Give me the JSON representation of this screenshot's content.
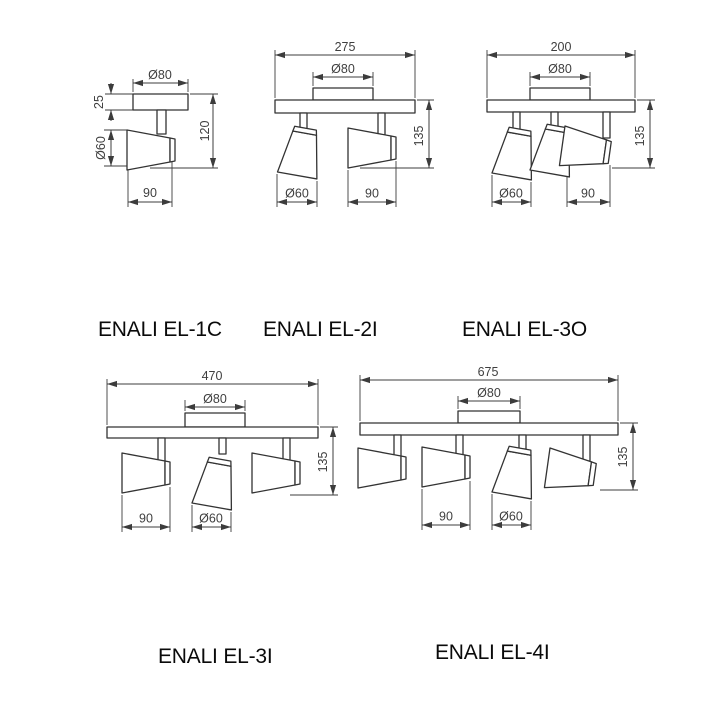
{
  "page": {
    "background": "#ffffff",
    "line_color": "#333333",
    "dimension_text_color": "#3f3f3f",
    "label_color": "#0a0a0a"
  },
  "figures": [
    {
      "name": "ENALI EL-1C",
      "type": "single ceiling spotlight drawing",
      "dims": {
        "canopy_diameter": "Ø80",
        "canopy_height": "25",
        "head_diameter": "Ø60",
        "total_height": "120",
        "head_length": "90"
      }
    },
    {
      "name": "ENALI EL-2I",
      "type": "2-head spotlight bar drawing",
      "dims": {
        "overall_length": "275",
        "canopy_diameter": "Ø80",
        "total_height": "135",
        "head_diameter": "Ø60",
        "head_length": "90"
      }
    },
    {
      "name": "ENALI EL-3O",
      "type": "3-head spotlight bar drawing",
      "dims": {
        "overall_length": "200",
        "canopy_diameter": "Ø80",
        "total_height": "135",
        "head_diameter": "Ø60",
        "head_length": "90"
      }
    },
    {
      "name": "ENALI EL-3I",
      "type": "3-head spotlight bar drawing",
      "dims": {
        "overall_length": "470",
        "canopy_diameter": "Ø80",
        "total_height": "135",
        "head_length": "90",
        "head_diameter": "Ø60"
      }
    },
    {
      "name": "ENALI EL-4I",
      "type": "4-head spotlight bar drawing",
      "dims": {
        "overall_length": "675",
        "canopy_diameter": "Ø80",
        "total_height": "135",
        "head_length": "90",
        "head_diameter": "Ø60"
      }
    }
  ]
}
